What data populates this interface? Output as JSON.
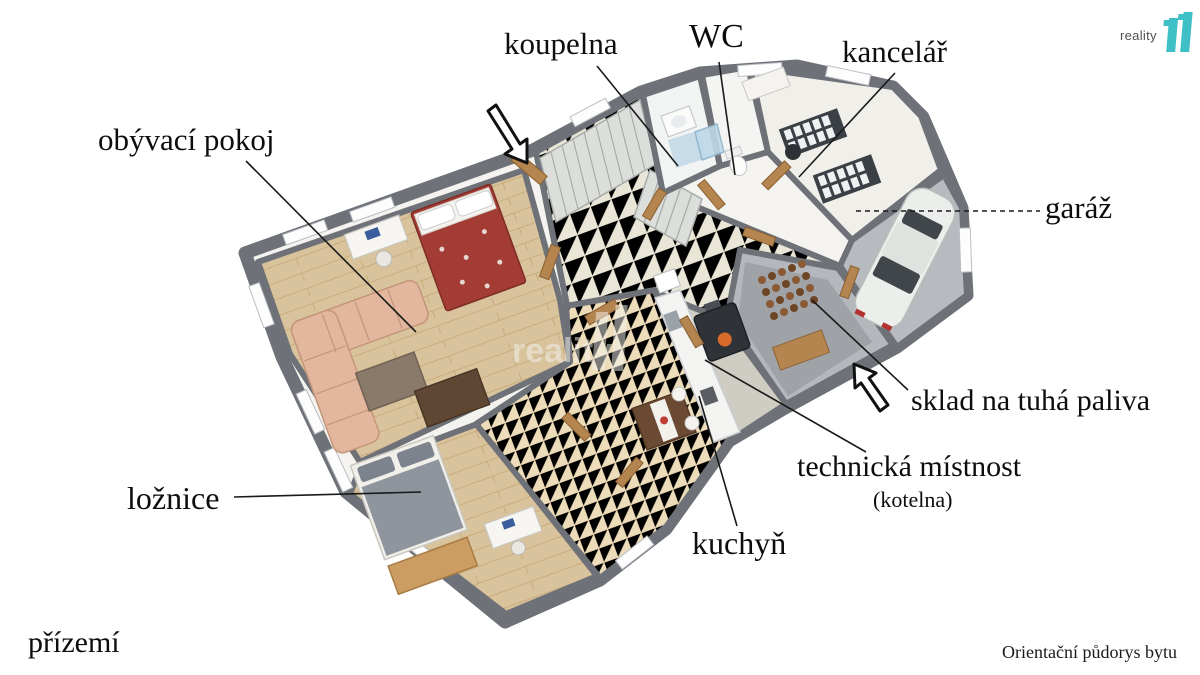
{
  "logo": {
    "brand": "reality",
    "number": "11",
    "accent_color": "#3fbfc6",
    "text_color": "#4f4f4f"
  },
  "watermark": {
    "text": "reality",
    "number": "11"
  },
  "labels": {
    "koupelna": "koupelna",
    "wc": "WC",
    "kancelar": "kancelář",
    "obyvaci_pokoj": "obývací pokoj",
    "garaz": "garáž",
    "sklad": "sklad na tuhá paliva",
    "technicka": "technická místnost",
    "kotelna": "(kotelna)",
    "kuchyn": "kuchyň",
    "loznice": "ložnice",
    "prizemi": "přízemí"
  },
  "footer": {
    "note": "Orientační půdorys bytu"
  },
  "colors": {
    "wall": "#6e7278",
    "wood_floor": "#d9c39c",
    "hall_tile": "#e9e6d8",
    "kitchen_tile": "#eddcba",
    "garage_floor": "#b7bbc0",
    "storage_floor": "#b4b7bc",
    "door_wood": "#b5854f",
    "sofa": "#e2b79d",
    "bed_living": "#a23c34",
    "bed_bedroom": "#8f959d",
    "label_text": "#0d0d0d",
    "leader_line": "#1a1a1a"
  }
}
